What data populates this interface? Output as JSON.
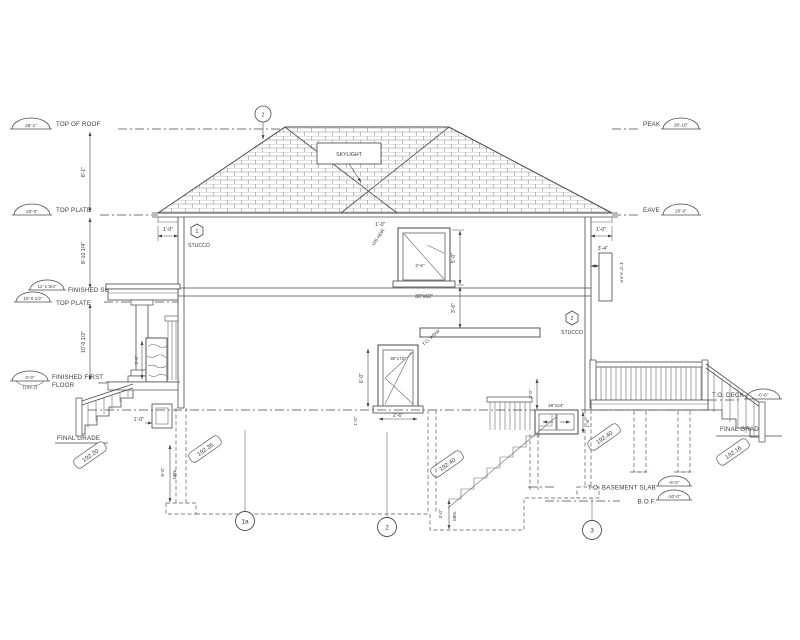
{
  "levels_left": [
    {
      "label": "TOP OF ROOF",
      "elev": "28'-1\""
    },
    {
      "label": "TOP PLATE",
      "elev": "20'-0\""
    },
    {
      "label": "FINISHED SECOND FLOOR",
      "elev": "11'-1 3/4\""
    },
    {
      "label": "TOP PLATE",
      "elev": "10'-0 1/2\""
    },
    {
      "label": "FINISHED FIRST",
      "label2": "FLOOR",
      "elev": "0'-0\"",
      "elev_geodetic": "(192.2)"
    },
    {
      "label": "FINAL GRADE"
    }
  ],
  "levels_right": [
    {
      "label": "PEAK",
      "elev": "28'-10\""
    },
    {
      "label": "EAVE",
      "elev": "20'-0\""
    },
    {
      "label": "T.O. DECK",
      "elev": "-0'-6\""
    },
    {
      "label": "FINAL GRADE"
    },
    {
      "label": "T.O. BASEMENT SLAB",
      "elev": "-9'-0\""
    },
    {
      "label": "B.O.F.",
      "elev": "-10'-0\""
    }
  ],
  "grade_tags": [
    "192.20",
    "192.35",
    "192.40",
    "192.40",
    "192.16"
  ],
  "grid_bubbles": [
    "1a",
    "2",
    "3"
  ],
  "keynotes": {
    "roof_circle": "2",
    "stucco_left_num": "1",
    "stucco_left": "STUCCO",
    "stucco_right_num": "2",
    "stucco_right": "STUCCO"
  },
  "windows": {
    "skylight": "SKYLIGHT",
    "second_floor_size": "30\"x60\"",
    "first_floor_size": "30\"x72\"",
    "basement_size": "48\"x24\""
  },
  "dimensions": {
    "roof_height": "8'-1\"",
    "second_storey": "8'-10 1/4\"",
    "first_storey": "10'-0 1/2\"",
    "eave_left": "1'-0\"",
    "eave_right": "1'-0\"",
    "w2_height": "5'-0\"",
    "w2_sill": "3'-0\"",
    "w2_glass": "2'-6\"",
    "w2_head": "1'-0\"",
    "w2_head_note": "U/S HDR",
    "w1_height": "6'-0\"",
    "w1_width": "2'-6\"",
    "w1_sill": "1'-0\"",
    "w1_note": "T.O. WDW",
    "porch_rail": "3'-0\"",
    "pier": "1'-0\"",
    "stair_guard": "3'-0\"",
    "bsmt_window": "1'-8\"",
    "vent": "3'-4\"",
    "vent_note": "1'-2\" A.F.F.",
    "footing_depth": "6'-0\"",
    "footing_min": "MIN.",
    "pit_depth": "4'-0\"",
    "pit_min": "MIN."
  }
}
